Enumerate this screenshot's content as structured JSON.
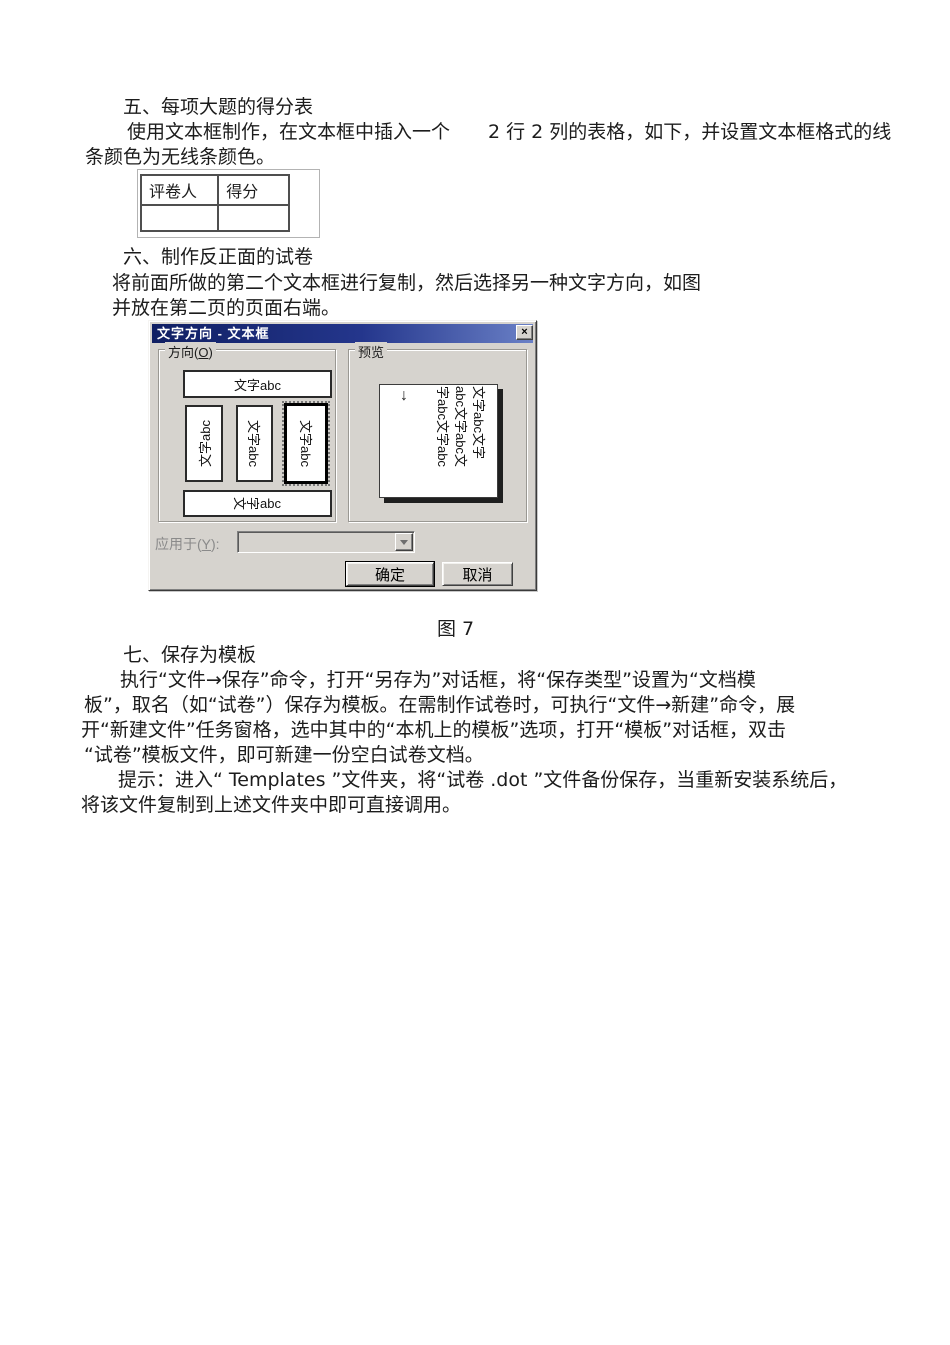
{
  "doc": {
    "section5": {
      "heading": "五、每项大题的得分表",
      "line1": "使用文本框制作，在文本框中插入一个　　2 行 2 列的表格，如下，并设置文本框格式的线",
      "line2": "条颜色为无线条颜色。"
    },
    "score_table": {
      "headers": [
        "评卷人",
        "得分"
      ],
      "rows": [
        [
          "",
          ""
        ]
      ]
    },
    "section6": {
      "heading": "六、制作反正面的试卷",
      "line1": "将前面所做的第二个文本框进行复制，然后选择另一种文字方向，如图",
      "line2": "并放在第二页的页面右端。"
    },
    "figure_caption": "图 7",
    "section7": {
      "heading": "七、保存为模板",
      "line1": "执行“文件→保存”命令，打开“另存为”对话框，将“保存类型”设置为“文档模",
      "line2": "板”，取名（如“试卷”）保存为模板。在需制作试卷时，可执行“文件→新建”命令，展",
      "line3": "开“新建文件”任务窗格，选中其中的“本机上的模板”选项，打开“模板”对话框，双击",
      "line4": "“试卷”模板文件，即可新建一份空白试卷文档。",
      "tip1": "提示：进入“ Templates ”文件夹，将“试卷 .dot ”文件备份保存，当重新安装系统后，",
      "tip2": "将该文件复制到上述文件夹中即可直接调用。"
    }
  },
  "dialog": {
    "title": "文字方向 - 文本框",
    "close_glyph": "×",
    "direction_group": {
      "pre": "方向(",
      "accel": "O",
      "post": ")"
    },
    "preview_group_label": "预览",
    "options": {
      "horizontal": "文字abc",
      "vertical_left": "文字abc",
      "vertical_right": "文字abc",
      "vertical_selected": "文字abc",
      "stacked_chars": [
        "文",
        "字"
      ],
      "stacked_latin": "abc"
    },
    "preview": {
      "arrow": "↓",
      "lines": [
        "文字abc文字",
        "abc文字abc文",
        "字abc文字abc"
      ]
    },
    "apply": {
      "pre": "应用于(",
      "accel": "Y",
      "post": "):"
    },
    "ok_label": "确定",
    "cancel_label": "取消",
    "colors": {
      "face": "#d6d3ce",
      "titlebar_start": "#101f63",
      "titlebar_end": "#6a80c6",
      "title_text": "#ffffff"
    }
  }
}
